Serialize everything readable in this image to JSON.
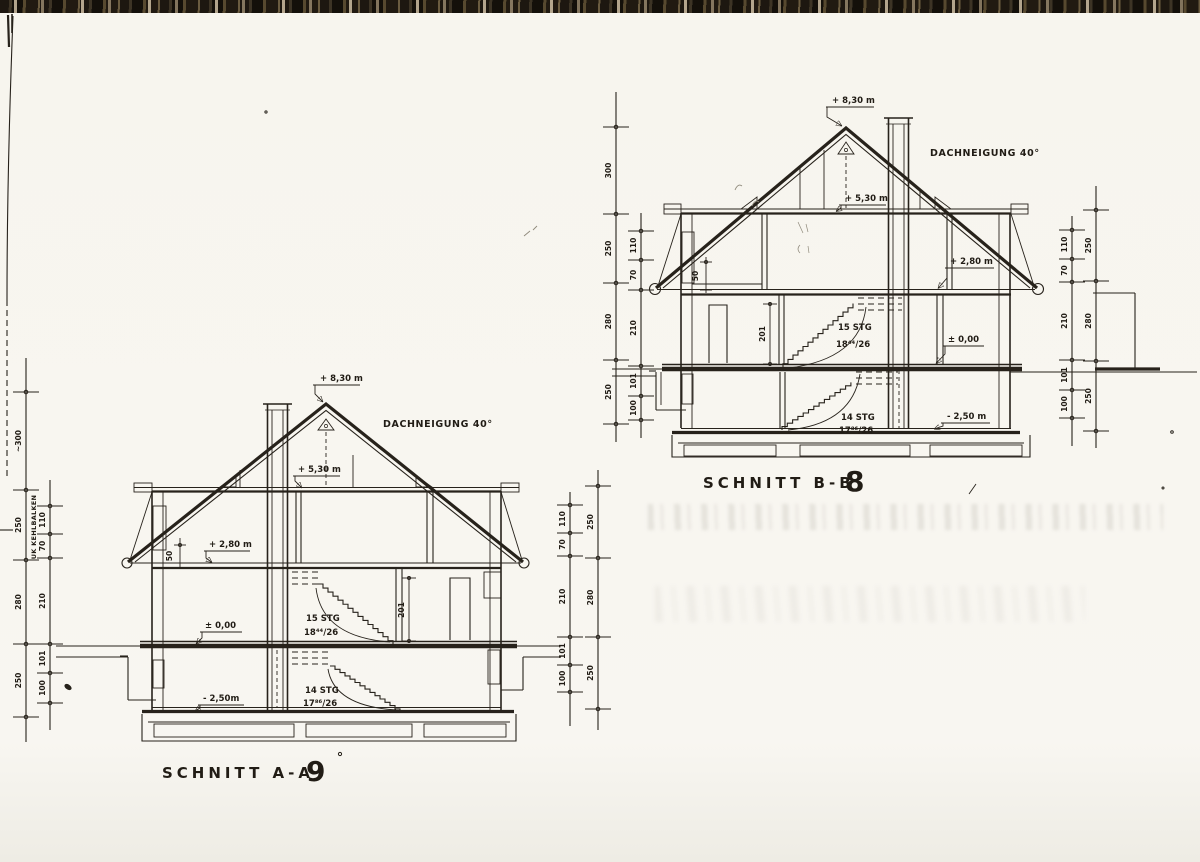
{
  "aa": {
    "title": "SCHNITT A-A",
    "number": "9",
    "ridge": "+ 8,30 m",
    "pitch": "DACHNEIGUNG  40°",
    "attic": "+ 5,30 m",
    "upper": "+ 2,80 m",
    "knee": "50",
    "room_height": "201",
    "ground": "± 0,00",
    "basement": "- 2,50m",
    "stair_up_1": "15 STG",
    "stair_up_2": "18⁴⁴/26",
    "stair_dn_1": "14 STG",
    "stair_dn_2": "17⁸⁶/26"
  },
  "bb": {
    "title": "SCHNITT B-B",
    "number": "8",
    "ridge": "+ 8,30 m",
    "pitch": "DACHNEIGUNG  40°",
    "attic": "+ 5,30 m",
    "upper": "+ 2,80 m",
    "knee": "50",
    "room_height": "201",
    "ground": "± 0,00",
    "basement": "- 2,50 m",
    "stair_up_1": "15 STG",
    "stair_up_2": "18⁴⁴/26",
    "stair_dn_1": "14 STG",
    "stair_dn_2": "17⁸⁶/26"
  },
  "margin_note": "UK KEHLBALKEN",
  "dim_chains": [
    {
      "id": "aa-left-outer",
      "x": 26,
      "top": 358,
      "bottom": 742,
      "ticks": [
        392,
        490,
        560,
        644,
        717
      ],
      "labels": [
        "~300",
        "250",
        "280",
        "250"
      ]
    },
    {
      "id": "aa-left-inner",
      "x": 50,
      "top": 480,
      "bottom": 730,
      "ticks": [
        506,
        534,
        558,
        644,
        673,
        703
      ],
      "labels": [
        "110",
        "70",
        "210",
        "101",
        "100"
      ]
    },
    {
      "id": "aa-right-inner",
      "x": 570,
      "top": 492,
      "bottom": 726,
      "ticks": [
        505,
        533,
        556,
        637,
        665,
        692
      ],
      "labels": [
        "110",
        "70",
        "210",
        "101",
        "100"
      ]
    },
    {
      "id": "aa-right-outer",
      "x": 598,
      "top": 470,
      "bottom": 730,
      "ticks": [
        486,
        558,
        637,
        709
      ],
      "labels": [
        "250",
        "280",
        "250"
      ]
    },
    {
      "id": "bb-left-outer",
      "x": 616,
      "top": 92,
      "bottom": 442,
      "ticks": [
        127,
        214,
        283,
        360,
        424
      ],
      "labels": [
        "300",
        "250",
        "280",
        "250"
      ]
    },
    {
      "id": "bb-left-inner",
      "x": 641,
      "top": 213,
      "bottom": 438,
      "ticks": [
        231,
        260,
        290,
        366,
        396,
        420
      ],
      "labels": [
        "110",
        "70",
        "210",
        "101",
        "100"
      ]
    },
    {
      "id": "bb-right-inner",
      "x": 1072,
      "top": 216,
      "bottom": 446,
      "ticks": [
        230,
        259,
        282,
        360,
        390,
        418
      ],
      "labels": [
        "110",
        "70",
        "210",
        "101",
        "100"
      ]
    },
    {
      "id": "bb-right-outer",
      "x": 1096,
      "top": 186,
      "bottom": 448,
      "ticks": [
        210,
        281,
        361,
        431
      ],
      "labels": [
        "250",
        "280",
        "250"
      ]
    }
  ]
}
